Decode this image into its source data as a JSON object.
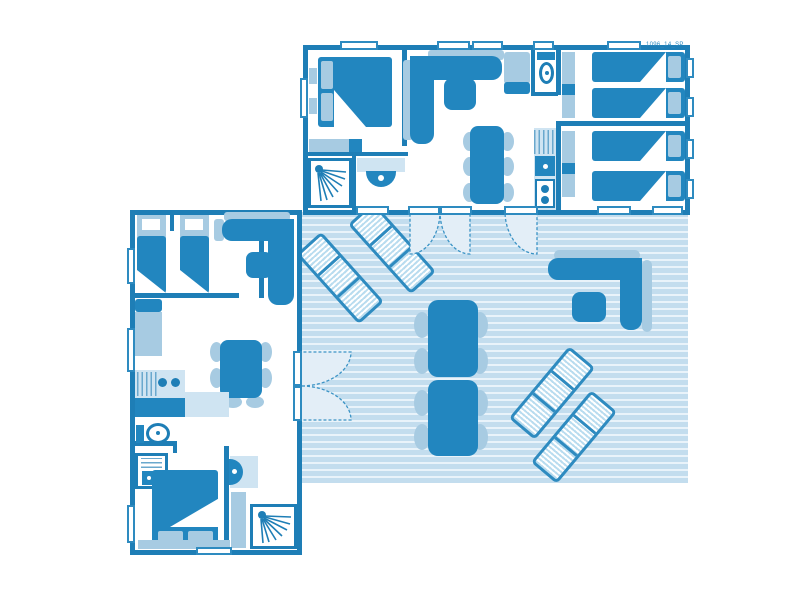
{
  "plan": {
    "ref": "1096_14_SP",
    "type": "mobile-home floor plan, two accommodation units joined by a shared deck terrace",
    "units": [
      {
        "id": "cottage-top",
        "rooms": [
          {
            "name": "bedroom-double",
            "furniture": [
              "double-bed",
              "two-pillows",
              "headboard-with-nightstands",
              "wardrobe"
            ]
          },
          {
            "name": "shower-room",
            "furniture": [
              "shower-cubicle",
              "washbasin"
            ]
          },
          {
            "name": "wc",
            "furniture": [
              "toilet"
            ]
          },
          {
            "name": "living-room",
            "furniture": [
              "corner-sofa",
              "coffee-table",
              "dining-table",
              "six-chairs",
              "armchair"
            ]
          },
          {
            "name": "kitchen",
            "furniture": [
              "drainer",
              "sink",
              "two-burner-hob"
            ]
          },
          {
            "name": "bedroom-twin-1",
            "furniture": [
              "single-bed",
              "single-bed",
              "wardrobe"
            ]
          },
          {
            "name": "bedroom-twin-2",
            "furniture": [
              "single-bed",
              "single-bed",
              "wardrobe"
            ]
          }
        ]
      },
      {
        "id": "cottage-left",
        "rooms": [
          {
            "name": "bedroom-twin",
            "furniture": [
              "single-bed",
              "single-bed"
            ]
          },
          {
            "name": "living-kitchen",
            "furniture": [
              "corner-sofa",
              "coffee-table",
              "dining-table",
              "six-chairs",
              "bench-sofa",
              "kitchen-counter",
              "drainer",
              "two-burner-hob"
            ]
          },
          {
            "name": "wc",
            "furniture": [
              "toilet",
              "water-heater"
            ]
          },
          {
            "name": "bedroom-double",
            "furniture": [
              "double-bed",
              "two-pillows",
              "bench"
            ]
          },
          {
            "name": "shower-room",
            "furniture": [
              "washbasin",
              "wardrobe",
              "shower-cubicle"
            ]
          }
        ]
      },
      {
        "id": "terrace",
        "furniture": [
          "sun-lounger",
          "sun-lounger",
          "sun-lounger",
          "sun-lounger",
          "outdoor-corner-sofa",
          "outdoor-coffee-table",
          "outdoor-table",
          "outdoor-table",
          "eight-outdoor-chairs"
        ],
        "doors": [
          "double-french-door-from-cottage-top",
          "single-door-from-cottage-top",
          "double-french-door-from-cottage-left"
        ]
      }
    ]
  },
  "colors": {
    "wall": "#1e7eb6",
    "furn": "#2286bf",
    "lite": "#a7cbe2",
    "pale": "#cfe4f2",
    "deck": "#c3ddee",
    "deckline": "#e9f3fa",
    "winb": "#2e8bc0",
    "arcfill": "#e3eef7",
    "arcstroke": "#3b93c5",
    "lstripe": "#b9dcef",
    "hatch": "#6aa8cd"
  }
}
